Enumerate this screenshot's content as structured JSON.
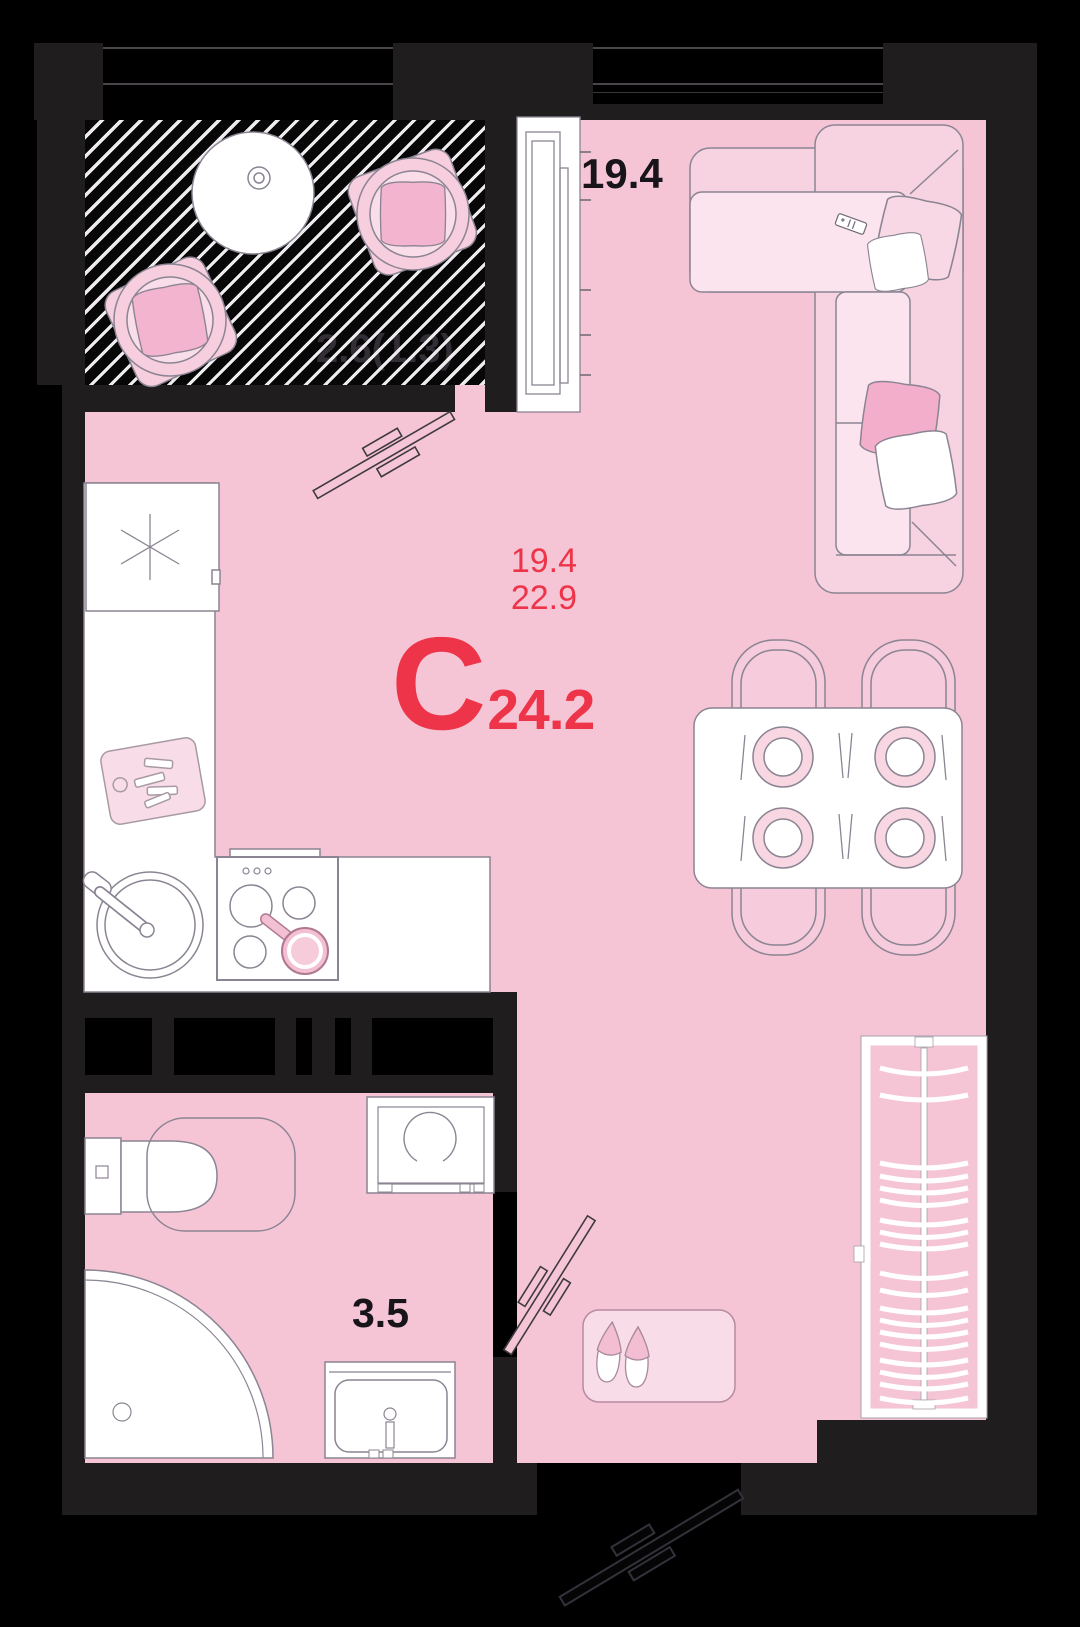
{
  "floorplan": {
    "unit_label": {
      "type_letter": "С",
      "total_area": "24.2",
      "living_area": "19.4",
      "area_with_balcony": "22.9"
    },
    "room_labels": {
      "living_room": "19.4",
      "bathroom": "3.5",
      "balcony": "2.6(1.3)"
    },
    "colors": {
      "background": "#000000",
      "wall": "#201d1f",
      "floor_pink": "#f5c5d6",
      "surface_light_pink": "#fbe4ee",
      "furniture_mid_pink": "#f7d2e0",
      "pillow_pink": "#f2aecb",
      "fixture_white": "#ffffff",
      "accent_red": "#ee3448",
      "outline_gray": "#8b8492"
    }
  }
}
